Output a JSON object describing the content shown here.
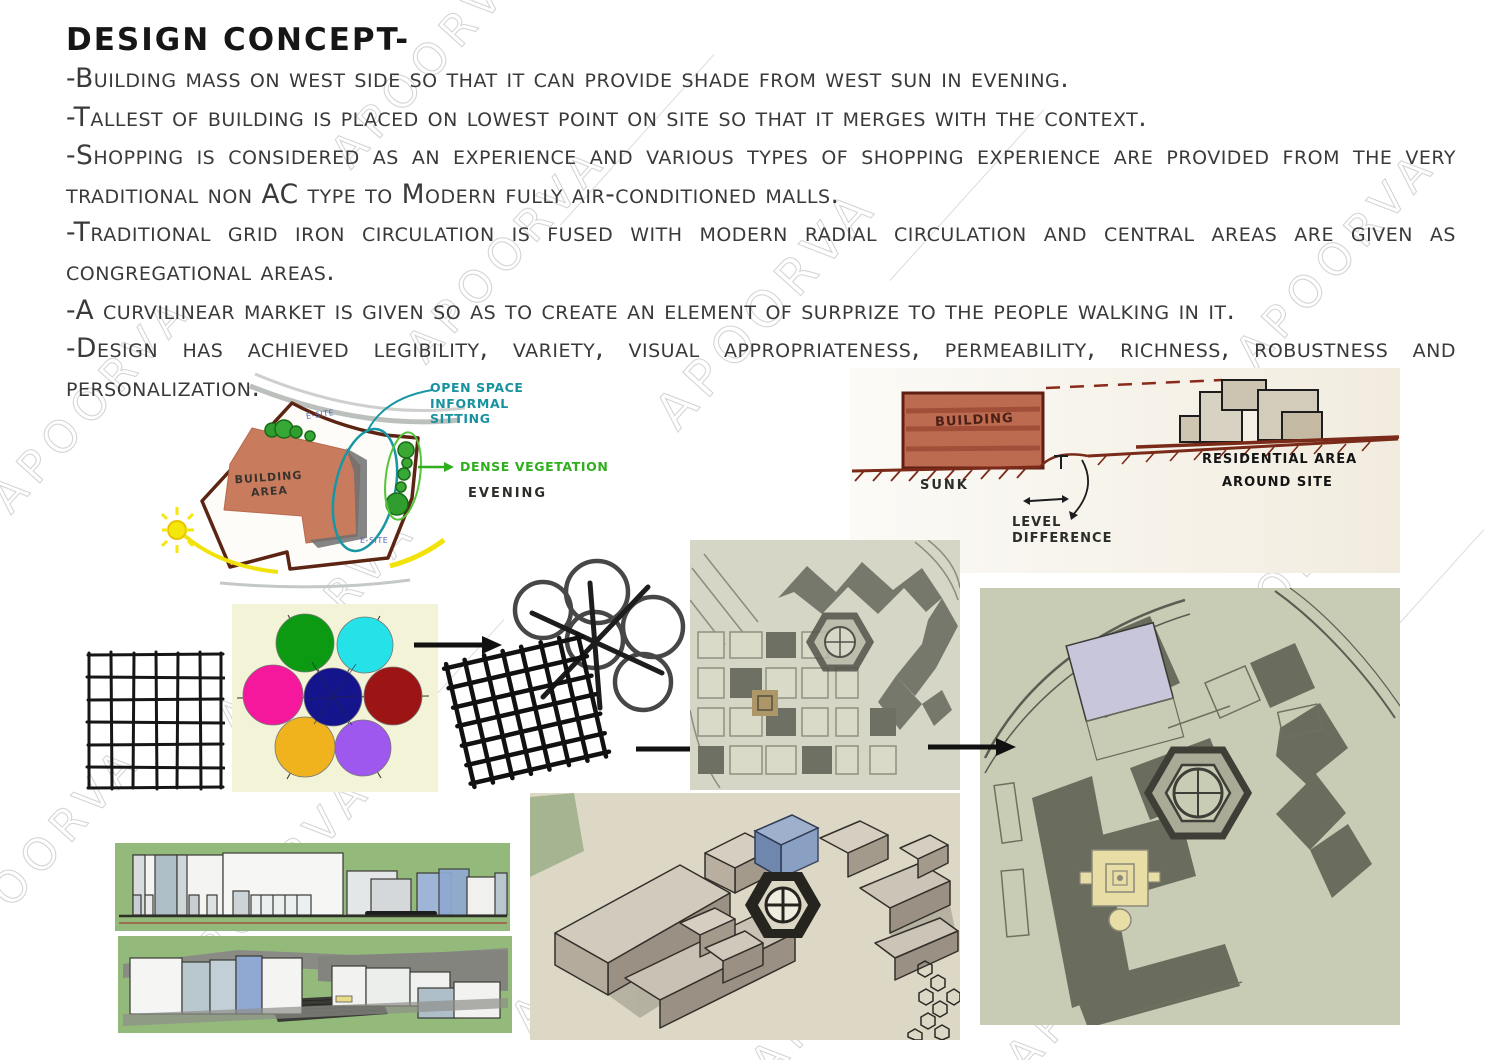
{
  "page": {
    "title": "DESIGN CONCEPT-",
    "bullets": [
      "-Building mass on west side so that it can provide shade from west sun in evening.",
      "-Tallest of building is placed on lowest point on site so that it merges with the context.",
      "-Shopping is considered as an experience and various types of shopping experience are provided from the very traditional non AC type to Modern fully air-conditioned malls.",
      "-Traditional grid iron circulation is fused with modern radial circulation and central areas are given as congregational areas.",
      "-A curvilinear market is given so as to create an element of surprize to the people walking in it.",
      "-Design has achieved legibility, variety, visual appropriateness, permeability, richness, robustness and personalization."
    ]
  },
  "watermark": {
    "text": "APOORVA"
  },
  "site_sketch": {
    "building_area_label": "BUILDING AREA",
    "open_space_label": "OPEN SPACE INFORMAL SITTING",
    "dense_vegetation_label": "DENSE VEGETATION",
    "evening_label": "EVENING",
    "site_note": "E-SITE"
  },
  "section_sketch": {
    "building_label": "BUILDING",
    "sunk_label": "SUNK",
    "level_difference_label": "LEVEL DIFFERENCE",
    "residential_line1": "RESIDENTIAL AREA",
    "residential_line2": "AROUND SITE"
  },
  "diagrams": {
    "circle_panel_bg": "#f3f4d7",
    "circle_colors": {
      "top_left": "#0b9a12",
      "top_right": "#25e2e8",
      "left": "#f5189d",
      "center": "#14148c",
      "right": "#9c1414",
      "bottom_left": "#f0b31e",
      "bottom_right": "#9e58ee"
    }
  }
}
